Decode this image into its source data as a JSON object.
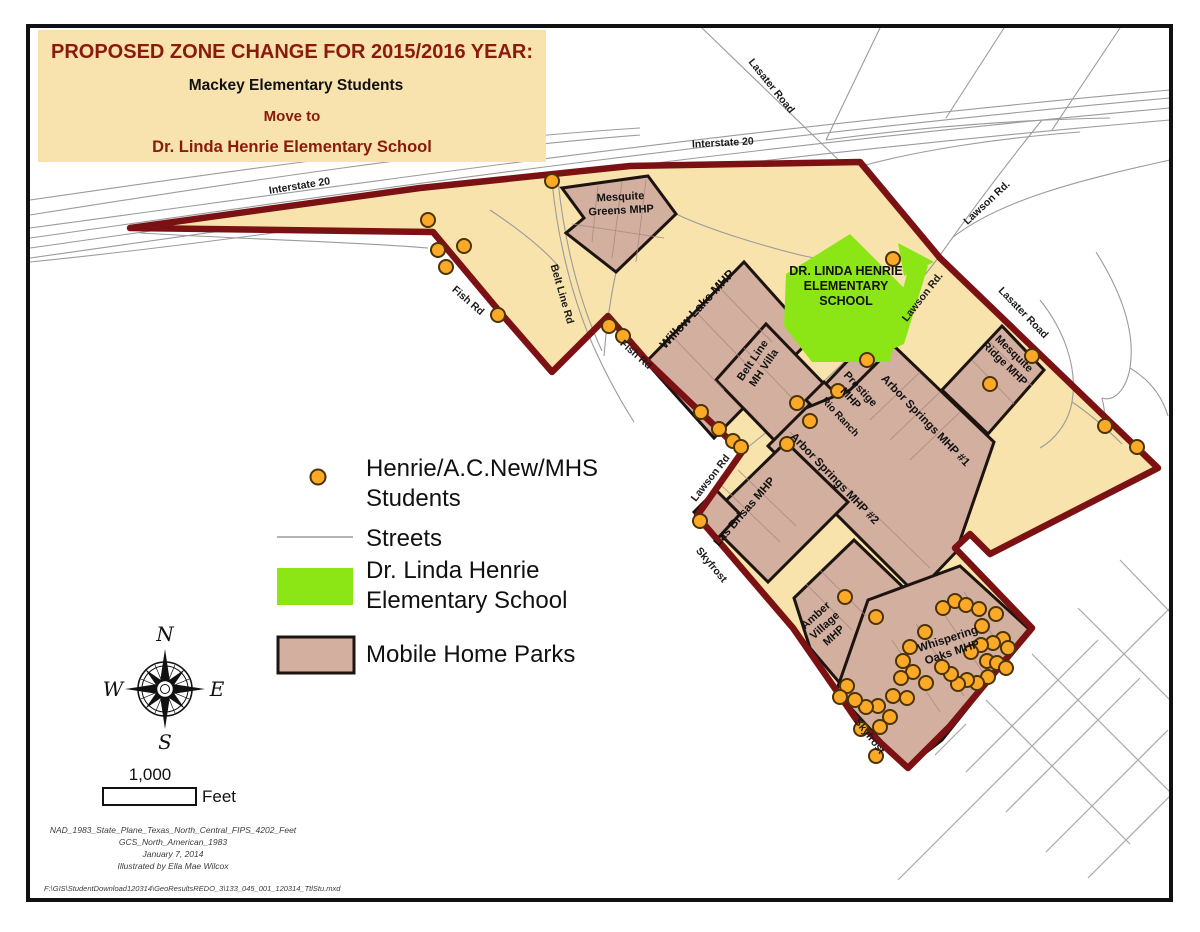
{
  "title": {
    "line1": "PROPOSED ZONE CHANGE FOR 2015/2016 YEAR:",
    "line2": "Mackey Elementary Students",
    "line3": "Move to",
    "line4": "Dr. Linda Henrie Elementary School"
  },
  "legend": {
    "students1": "Henrie/A.C.New/MHS",
    "students2": "Students",
    "streets": "Streets",
    "school1": "Dr. Linda Henrie",
    "school2": "Elementary School",
    "mhp": "Mobile Home Parks"
  },
  "scale": {
    "value": "1,000",
    "unit": "Feet"
  },
  "compass": {
    "n": "N",
    "e": "E",
    "s": "S",
    "w": "W"
  },
  "footer": {
    "lines": [
      "NAD_1983_State_Plane_Texas_North_Central_FIPS_4202_Feet",
      "GCS_North_American_1983",
      "January 7, 2014",
      "Illustrated by Ella Mae Wilcox"
    ],
    "path": "F:\\GIS\\StudentDownload120314\\GeoResultsREDO_3\\133_045_001_120314_TtlStu.mxd"
  },
  "colors": {
    "zone_fill": "#F8E3AC",
    "zone_border": "#7C1114",
    "mhp_fill": "#D3AFA0",
    "mhp_border": "#1d1410",
    "school_green": "#8CE616",
    "dot_fill": "#FDA928",
    "dot_stroke": "#4a3305",
    "title_maroon": "#8A1A0C",
    "title_box": "#F8E2AE"
  },
  "map": {
    "zone_outline": "130,228 420,188 630,166 860,162 940,258 1158,468 990,554 970,534 955,548 1032,628 950,726 908,768 858,722 836,690 793,628 697,516 742,452 648,362 608,316 552,372 505,318 433,232",
    "park_shapes": [
      {
        "id": "mesquite-greens",
        "points": "562,188 648,176 676,214 616,272 566,233 584,218"
      },
      {
        "id": "willow-lake",
        "points": "646,362 744,262 812,338 714,438"
      },
      {
        "id": "belt-line-mh-villa",
        "points": "716,380 766,324 826,386 776,442"
      },
      {
        "id": "prestige",
        "points": "858,350 898,392 858,436 818,392"
      },
      {
        "id": "rio-ranch",
        "points": "806,400 824,382 872,430 854,448"
      },
      {
        "id": "arbor-springs",
        "points": "806,408 850,390 894,346 994,442 956,552 916,594 768,446"
      },
      {
        "id": "las-brisas",
        "points": "706,520 786,442 848,502 768,582"
      },
      {
        "id": "las-brisas-annex",
        "points": "694,512 716,490 740,514 718,538"
      },
      {
        "id": "amber-village",
        "points": "794,598 854,540 906,590 844,688 810,648"
      },
      {
        "id": "whispering-oaks",
        "points": "868,600 960,566 1030,630 942,740 906,768 836,692"
      },
      {
        "id": "mesquite-ridge",
        "points": "1002,326 1044,370 988,434 942,390"
      }
    ],
    "school_shapes": [
      "850,234 906,290 890,362 812,362 784,326 786,274",
      "912,256 928,266 904,344 886,352 890,336",
      "898,243 934,262 904,276"
    ],
    "school_label": {
      "lines": [
        "DR. LINDA HENRIE",
        "ELEMENTARY",
        "SCHOOL"
      ],
      "x": 846,
      "y": 290,
      "size": 12.5,
      "lh": 17
    },
    "park_labels": [
      {
        "lines": [
          "Mesquite",
          "Greens MHP"
        ],
        "x": 621,
        "y": 207,
        "rot": -3,
        "size": 11
      },
      {
        "lines": [
          "Willow Lake MHP"
        ],
        "x": 700,
        "y": 312,
        "rot": -47,
        "size": 12.5
      },
      {
        "lines": [
          "Belt Line",
          "MH Villa"
        ],
        "x": 761,
        "y": 366,
        "rot": -56,
        "size": 11
      },
      {
        "lines": [
          "Prestige",
          "MHP"
        ],
        "x": 853,
        "y": 396,
        "rot": 47,
        "size": 11
      },
      {
        "lines": [
          "Rio Ranch"
        ],
        "x": 838,
        "y": 419,
        "rot": 47,
        "size": 10
      },
      {
        "lines": [
          "Arbor Springs MHP #1"
        ],
        "x": 923,
        "y": 423,
        "rot": 46,
        "size": 11.5
      },
      {
        "lines": [
          "Arbor Springs MHP #2"
        ],
        "x": 832,
        "y": 481,
        "rot": 46,
        "size": 11.5
      },
      {
        "lines": [
          "Las Brisas MHP"
        ],
        "x": 747,
        "y": 514,
        "rot": -49,
        "size": 11.5
      },
      {
        "lines": [
          "Amber",
          "Village",
          "MHP"
        ],
        "x": 827,
        "y": 628,
        "rot": -42,
        "size": 11
      },
      {
        "lines": [
          "Whispering",
          "Oaks MHP"
        ],
        "x": 951,
        "y": 649,
        "rot": -18,
        "size": 11.5
      },
      {
        "lines": [
          "Mesquite",
          "Ridge MHP"
        ],
        "x": 1007,
        "y": 361,
        "rot": 44,
        "size": 11
      }
    ],
    "road_labels": [
      {
        "text": "Interstate 20",
        "x": 300,
        "y": 189,
        "rot": -9
      },
      {
        "text": "Interstate 20",
        "x": 723,
        "y": 146,
        "rot": -3
      },
      {
        "text": "Lasater Road",
        "x": 769,
        "y": 88,
        "rot": 51
      },
      {
        "text": "Lasater Road",
        "x": 1021,
        "y": 315,
        "rot": 46
      },
      {
        "text": "Lawson Rd.",
        "x": 989,
        "y": 205,
        "rot": -43
      },
      {
        "text": "Lawson Rd.",
        "x": 925,
        "y": 299,
        "rot": -52
      },
      {
        "text": "Lawson Rd",
        "x": 713,
        "y": 480,
        "rot": -52
      },
      {
        "text": "Belt Line Rd",
        "x": 559,
        "y": 295,
        "rot": 74
      },
      {
        "text": "Fish Rd",
        "x": 466,
        "y": 303,
        "rot": 41
      },
      {
        "text": "Fish Rd",
        "x": 634,
        "y": 357,
        "rot": 41
      },
      {
        "text": "Skyfrost",
        "x": 709,
        "y": 567,
        "rot": 50
      },
      {
        "text": "Skyfrost",
        "x": 867,
        "y": 738,
        "rot": 52
      }
    ],
    "student_dots": [
      [
        552,
        181
      ],
      [
        428,
        220
      ],
      [
        438,
        250
      ],
      [
        464,
        246
      ],
      [
        446,
        267
      ],
      [
        498,
        315
      ],
      [
        609,
        326
      ],
      [
        623,
        336
      ],
      [
        701,
        412
      ],
      [
        719,
        429
      ],
      [
        733,
        441
      ],
      [
        741,
        447
      ],
      [
        787,
        444
      ],
      [
        797,
        403
      ],
      [
        810,
        421
      ],
      [
        838,
        391
      ],
      [
        867,
        360
      ],
      [
        893,
        259
      ],
      [
        700,
        521
      ],
      [
        990,
        384
      ],
      [
        1032,
        356
      ],
      [
        1105,
        426
      ],
      [
        1137,
        447
      ],
      [
        845,
        597
      ],
      [
        876,
        617
      ],
      [
        943,
        608
      ],
      [
        955,
        601
      ],
      [
        966,
        605
      ],
      [
        979,
        609
      ],
      [
        996,
        614
      ],
      [
        1003,
        639
      ],
      [
        1008,
        648
      ],
      [
        993,
        643
      ],
      [
        981,
        645
      ],
      [
        982,
        626
      ],
      [
        971,
        652
      ],
      [
        987,
        661
      ],
      [
        997,
        663
      ],
      [
        1006,
        668
      ],
      [
        988,
        677
      ],
      [
        977,
        683
      ],
      [
        967,
        680
      ],
      [
        958,
        684
      ],
      [
        951,
        674
      ],
      [
        942,
        667
      ],
      [
        925,
        632
      ],
      [
        910,
        647
      ],
      [
        903,
        661
      ],
      [
        913,
        672
      ],
      [
        901,
        678
      ],
      [
        893,
        696
      ],
      [
        907,
        698
      ],
      [
        926,
        683
      ],
      [
        890,
        717
      ],
      [
        878,
        706
      ],
      [
        866,
        707
      ],
      [
        855,
        700
      ],
      [
        847,
        686
      ],
      [
        840,
        697
      ],
      [
        861,
        729
      ],
      [
        880,
        727
      ],
      [
        876,
        756
      ]
    ]
  }
}
